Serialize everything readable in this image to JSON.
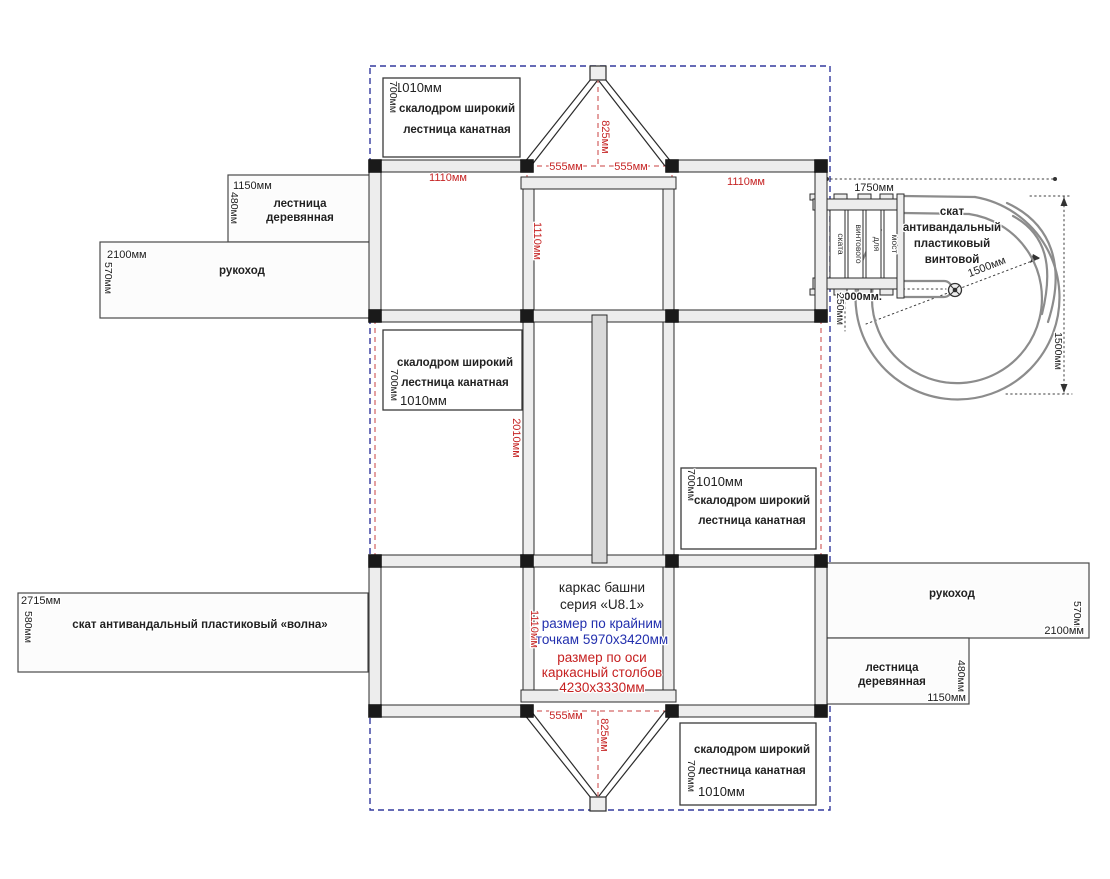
{
  "title": {
    "name1": "каркас башни",
    "name2": "серия «U8.1»",
    "extreme1": "размер по крайним",
    "extreme2": "точкам 5970х3420мм",
    "axis1": "размер по оси",
    "axis2": "каркасный столбов",
    "axis3": "4230х3330мм"
  },
  "labels": {
    "box_top_left": {
      "width": "1010мм",
      "height": "700мм",
      "row1": "скалодром широкий",
      "row2": "лестница канатная"
    },
    "box_mid_left": {
      "width": "1010мм",
      "height": "700мм",
      "row1": "скалодром широкий",
      "row2": "лестница канатная"
    },
    "box_mid_right": {
      "width": "1010мм",
      "height": "700мм",
      "row1": "скалодром широкий",
      "row2": "лестница канатная"
    },
    "box_bottom_right": {
      "width": "1010мм",
      "height": "700мм",
      "row1": "скалодром широкий",
      "row2": "лестница канатная"
    },
    "ladder_left": {
      "width": "1150мм",
      "height": "480мм",
      "row1": "лестница",
      "row2": "деревянная"
    },
    "rukohod_left": {
      "width": "2100мм",
      "height": "570мм",
      "name": "рукоход"
    },
    "wave_slide": {
      "width": "2715мм",
      "height": "580мм",
      "name": "скат антивандальный пластиковый «волна»"
    },
    "rukohod_right": {
      "width": "2100мм",
      "height": "570мм",
      "name": "рукоход"
    },
    "ladder_right": {
      "width": "1150мм",
      "height": "480мм",
      "row1": "лестница",
      "row2": "деревянная"
    },
    "spiral_slide": {
      "row1": "скат",
      "row2": "антивандальный",
      "row3": "пластиковый",
      "row4": "винтовой"
    },
    "bridge": {
      "plank1": "ската",
      "plank2": "винтового",
      "plank3": "для",
      "plank4": "мост"
    }
  },
  "dims": {
    "bay_top_left": "1110мм",
    "bay_center_vert": "1110мм",
    "bay_top_right": "1110мм",
    "gable_top_left": "555мм",
    "gable_top_right": "555мм",
    "gable_top_height": "825мм",
    "corridor_height": "2010мм",
    "bay_bottom_vert": "1110мм",
    "gable_bottom_width": "555мм",
    "gable_bottom_height": "825мм",
    "bridge_span": "1750мм",
    "spiral_radius": "1500мм",
    "spiral_diameter": "1500мм",
    "bridge_length": "1000мм.",
    "bridge_offset": "250мм"
  },
  "colors": {
    "dim_red": "#c62525",
    "note_blue": "#2330ae",
    "axis_red": "#c84040",
    "boundary_blue": "#333a9e"
  }
}
